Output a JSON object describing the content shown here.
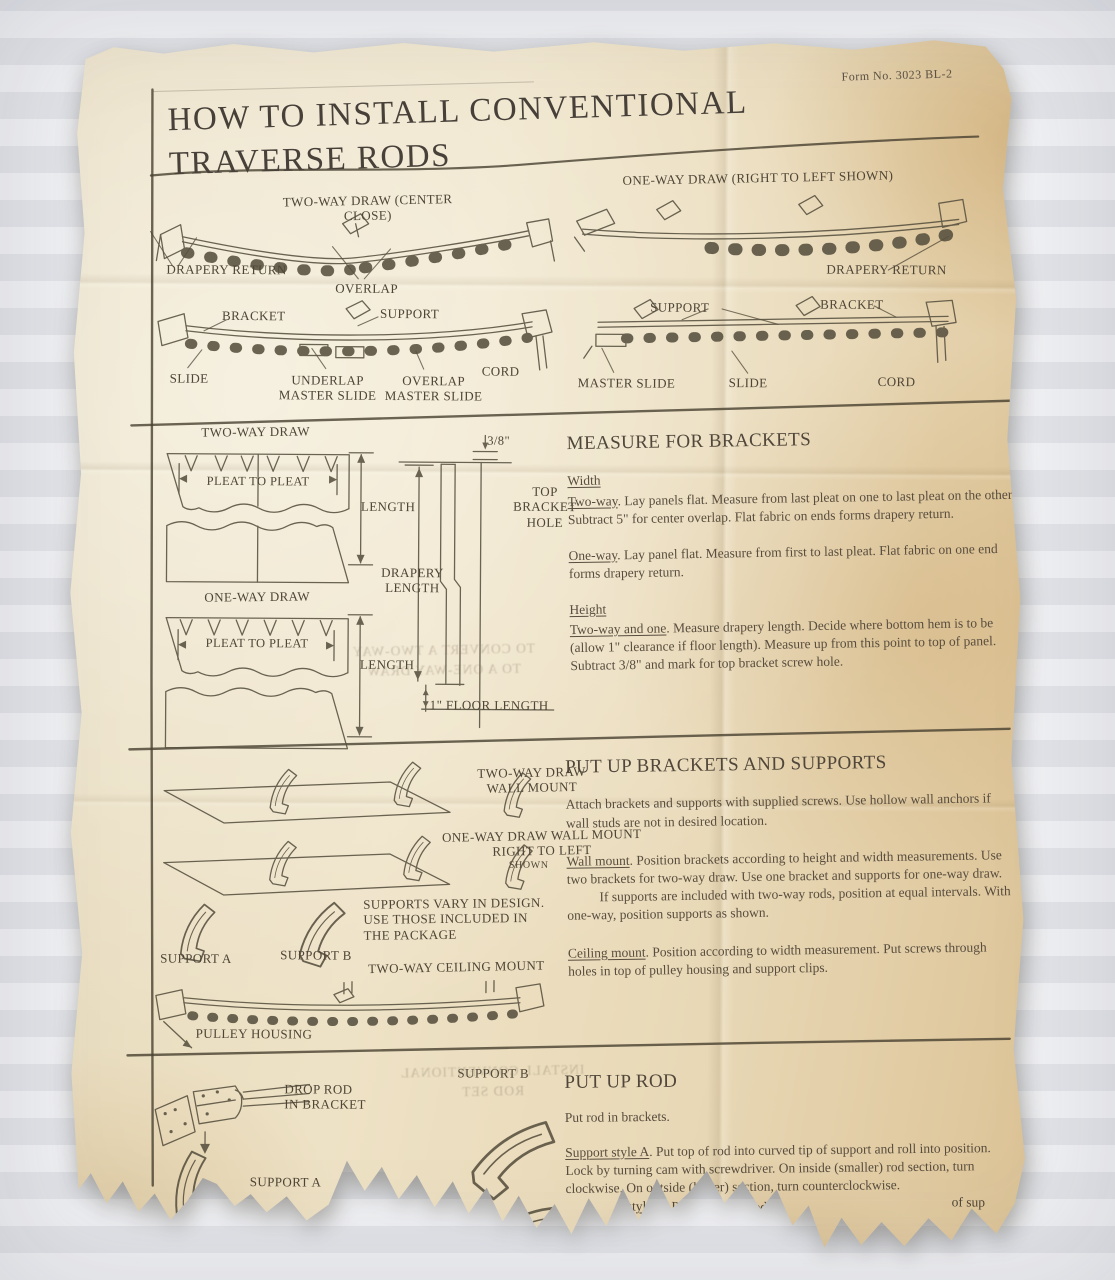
{
  "page": {
    "title": "HOW TO INSTALL CONVENTIONAL\nTRAVERSE RODS",
    "form_number": "Form No. 3023 BL-2"
  },
  "colors": {
    "paper": "#ebdfc2",
    "paper_edge_tan": "#dcc295",
    "ink": "#4e4536",
    "background_gray": "#e8eaed"
  },
  "top_left": {
    "caption": "TWO-WAY DRAW (CENTER CLOSE)",
    "drapery_return": "DRAPERY RETURN",
    "overlap": "OVERLAP",
    "bracket": "BRACKET",
    "support": "SUPPORT",
    "slide": "SLIDE",
    "underlap_master_slide": "UNDERLAP\nMASTER SLIDE",
    "overlap_master_slide": "OVERLAP\nMASTER SLIDE",
    "cord": "CORD"
  },
  "top_right": {
    "caption": "ONE-WAY DRAW (RIGHT TO LEFT SHOWN)",
    "drapery_return": "DRAPERY RETURN",
    "support": "SUPPORT",
    "bracket": "BRACKET",
    "master_slide": "MASTER SLIDE",
    "slide": "SLIDE",
    "cord": "CORD"
  },
  "measure_diagram": {
    "two_way_caption": "TWO-WAY DRAW",
    "one_way_caption": "ONE-WAY DRAW",
    "pleat_to_pleat": "PLEAT TO PLEAT",
    "length": "LENGTH",
    "drapery_length": "DRAPERY\nLENGTH",
    "three_eighths": "3/8\"",
    "top_bracket_hole": "TOP\nBRACKET\nHOLE",
    "floor_length": "1\" FLOOR LENGTH"
  },
  "measure_text": {
    "heading": "MEASURE FOR BRACKETS",
    "width_label": "Width",
    "p1_lead": "Two-way",
    "p1_rest": ". Lay panels flat. Measure from last pleat on one to last pleat on the other. Subtract 5\" for center overlap. Flat fabric on ends forms drapery return.",
    "p2_lead": "One-way",
    "p2_rest": ". Lay panel flat. Measure from first to last pleat. Flat fabric on one end forms drapery return.",
    "height_label": "Height",
    "p3_lead": "Two-way and one",
    "p3_rest": ". Measure drapery length. Decide where bottom hem is to be (allow 1\" clearance if floor length). Measure up from this point to top of panel. Subtract 3/8\" and mark for top bracket screw hole."
  },
  "brackets_diagram": {
    "two_way_wall_mount": "TWO-WAY DRAW\nWALL MOUNT",
    "one_way_wall_mount": "ONE-WAY DRAW WALL MOUNT\nRIGHT TO LEFT",
    "shown": "SHOWN",
    "supports_vary": "SUPPORTS VARY IN DESIGN.\nUSE THOSE INCLUDED IN\nTHE PACKAGE",
    "support_a": "SUPPORT A",
    "support_b": "SUPPORT B",
    "ceiling_caption": "TWO-WAY CEILING MOUNT",
    "pulley_housing": "PULLEY HOUSING"
  },
  "brackets_text": {
    "heading": "PUT UP BRACKETS AND SUPPORTS",
    "p0": "Attach brackets and supports with supplied screws. Use hollow wall anchors if wall studs are not in desired location.",
    "p1_lead": "Wall mount",
    "p1_rest": ". Position brackets according to height and width measurements. Use two brackets for two-way draw. Use one bracket and supports for one-way draw.",
    "p2": "If supports are included with two-way rods, position at equal intervals. With one-way, position supports as shown.",
    "p3_lead": "Ceiling mount",
    "p3_rest": ". Position according to width measurement. Put screws through holes in top of pulley housing and support clips."
  },
  "rod_diagram": {
    "drop_rod": "DROP ROD\nIN BRACKET",
    "support_b": "SUPPORT B",
    "support_a": "SUPPORT A"
  },
  "rod_text": {
    "heading": "PUT UP ROD",
    "p0": "Put rod in brackets.",
    "p1_lead": "Support style A",
    "p1_rest": ". Put top of rod into curved tip of support and roll into position. Lock by turning cam with screwdriver. On inside (smaller) rod section, turn clockwise. On outside (larger) section, turn counterclockwise.",
    "frag1_lead": "t style B",
    "frag1_rest": ". Put bottom of rod in",
    "frag1b": "of sup",
    "frag2": "d until it sna",
    "frag3": "ction"
  },
  "ghost": {
    "g1": "TO CONVERT A TWO-WAY\nTO A ONE-WAY DRAW",
    "g2": "INSTALL CONVENTIONAL\nROD SET"
  }
}
